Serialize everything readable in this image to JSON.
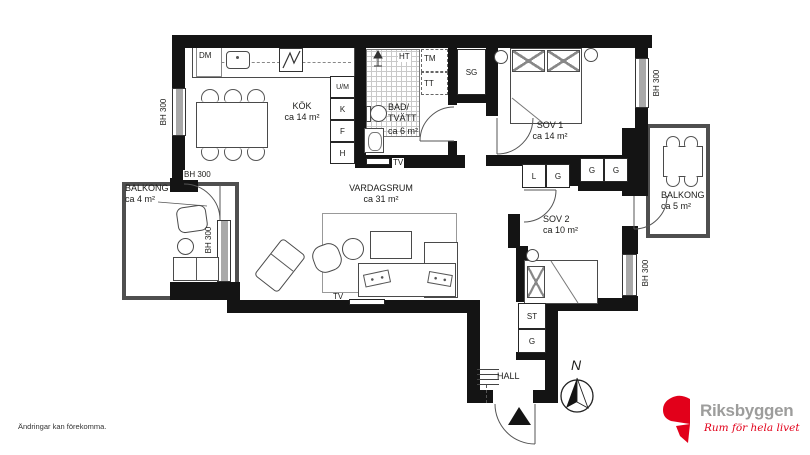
{
  "rooms": {
    "kitchen": {
      "name": "KÖK",
      "area": "ca 14 m²"
    },
    "bathroom": {
      "name_line1": "BAD/",
      "name_line2": "TVÄTT",
      "area": "ca 6 m²"
    },
    "living_room": {
      "name": "VARDAGSRUM",
      "area": "ca 31 m²"
    },
    "bedroom1": {
      "name": "SOV 1",
      "area": "ca 14 m²"
    },
    "bedroom2": {
      "name": "SOV 2",
      "area": "ca 10 m²"
    },
    "balcony_left": {
      "name": "BALKONG",
      "area": "ca 4 m²"
    },
    "balcony_right": {
      "name": "BALKONG",
      "area": "ca 5 m²"
    },
    "hall": {
      "name": "HALL"
    }
  },
  "fixtures": {
    "dishwasher": "DM",
    "towel_dryer": "HT",
    "washing_machine": "TM",
    "tumble_dryer": "TT",
    "cleaning_closet": "SG",
    "oven_microwave": "U/M",
    "fridge": "K",
    "freezer": "F",
    "tall_cabinet": "H",
    "tv_outlet": "TV",
    "linen_closet": "L",
    "wardrobe": "G",
    "storage_closet": "ST"
  },
  "annotations": {
    "window_height": "BH 300",
    "compass_north": "N"
  },
  "footer": {
    "disclaimer": "Ändringar kan förekomma."
  },
  "brand": {
    "name": "Riksbyggen",
    "tagline": "Rum för hela livet",
    "logo_color": "#e2001a",
    "name_color": "#9d9d9c"
  }
}
